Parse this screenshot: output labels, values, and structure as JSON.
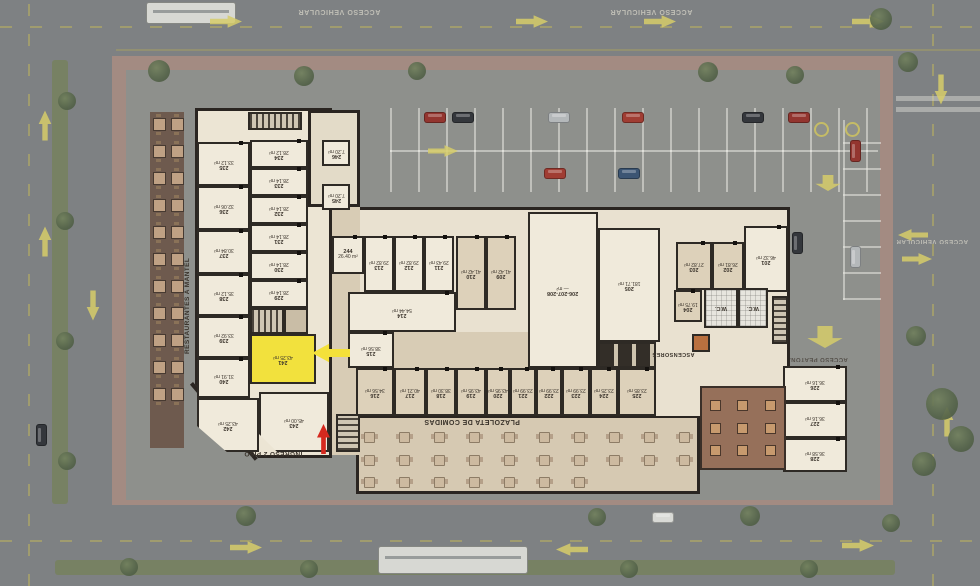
{
  "labels": {
    "restaurantes": "RESTAURANTES A MANTEL",
    "ingreso": "INGRESO 2 PISO",
    "plazoleta": "PLAZOLETA DE COMIDAS",
    "ascensores": "ASCENSORES",
    "acceso_vehicular": "ACCESO VEHICULAR",
    "acceso_peatonal": "ACCESO PEATONAL",
    "wc": "W.C."
  },
  "colors": {
    "highlight_unit": "#F2E13D",
    "entrance_arrow": "#D5291F",
    "traffic_arrow": "#D6CD6A"
  },
  "highlight": {
    "unit": "241"
  },
  "units": {
    "u201": {
      "num": "201",
      "area": "46.32 m²"
    },
    "u202": {
      "num": "202",
      "area": "26.81 m²"
    },
    "u203": {
      "num": "203",
      "area": "27.82 m²"
    },
    "u204": {
      "num": "204",
      "area": "19.75 m²"
    },
    "u205": {
      "num": "205",
      "area": "181.71 m²"
    },
    "u206_208": {
      "num": "206-207-208",
      "area": "— m²"
    },
    "u209": {
      "num": "209",
      "area": "41.42 m²"
    },
    "u210": {
      "num": "210",
      "area": "41.42 m²"
    },
    "u211": {
      "num": "211",
      "area": "29.43 m²"
    },
    "u212": {
      "num": "212",
      "area": "29.82 m²"
    },
    "u213": {
      "num": "213",
      "area": "29.82 m²"
    },
    "u214": {
      "num": "214",
      "area": "54.44 m²"
    },
    "u215": {
      "num": "215",
      "area": "38.56 m²"
    },
    "u216": {
      "num": "216",
      "area": "34.56 m²"
    },
    "u217": {
      "num": "217",
      "area": "40.21 m²"
    },
    "u218": {
      "num": "218",
      "area": "38.30 m²"
    },
    "u219": {
      "num": "219",
      "area": "43.95 m²"
    },
    "u220": {
      "num": "220",
      "area": "43.95 m²"
    },
    "u221": {
      "num": "221",
      "area": "23.99 m²"
    },
    "u222": {
      "num": "222",
      "area": "23.99 m²"
    },
    "u223": {
      "num": "223",
      "area": "23.99 m²"
    },
    "u224": {
      "num": "224",
      "area": "23.25 m²"
    },
    "u225": {
      "num": "225",
      "area": "23.85 m²"
    },
    "u226": {
      "num": "226",
      "area": "36.16 m²"
    },
    "u227": {
      "num": "227",
      "area": "36.16 m²"
    },
    "u228": {
      "num": "228",
      "area": "36.58 m²"
    },
    "u229": {
      "num": "229",
      "area": "28.14 m²"
    },
    "u230": {
      "num": "230",
      "area": "28.14 m²"
    },
    "u231": {
      "num": "231",
      "area": "28.14 m²"
    },
    "u232": {
      "num": "232",
      "area": "28.14 m²"
    },
    "u233": {
      "num": "233",
      "area": "28.14 m²"
    },
    "u234": {
      "num": "234",
      "area": "28.12 m²"
    },
    "u235": {
      "num": "235",
      "area": "33.12 m²"
    },
    "u236": {
      "num": "236",
      "area": "32.06 m²"
    },
    "u237": {
      "num": "237",
      "area": "30.84 m²"
    },
    "u238": {
      "num": "238",
      "area": "35.12 m²"
    },
    "u239": {
      "num": "239",
      "area": "33.92 m²"
    },
    "u240": {
      "num": "240",
      "area": "31.91 m²"
    },
    "u241": {
      "num": "241",
      "area": "43.25 m²"
    },
    "u242": {
      "num": "242",
      "area": "43.25 m²"
    },
    "u243": {
      "num": "243",
      "area": "45.00 m²"
    },
    "u244": {
      "num": "244",
      "area": "26.40 m²"
    },
    "u245": {
      "num": "245",
      "area": "7.20 m²"
    },
    "u246": {
      "num": "246",
      "area": "7.20 m²"
    }
  }
}
